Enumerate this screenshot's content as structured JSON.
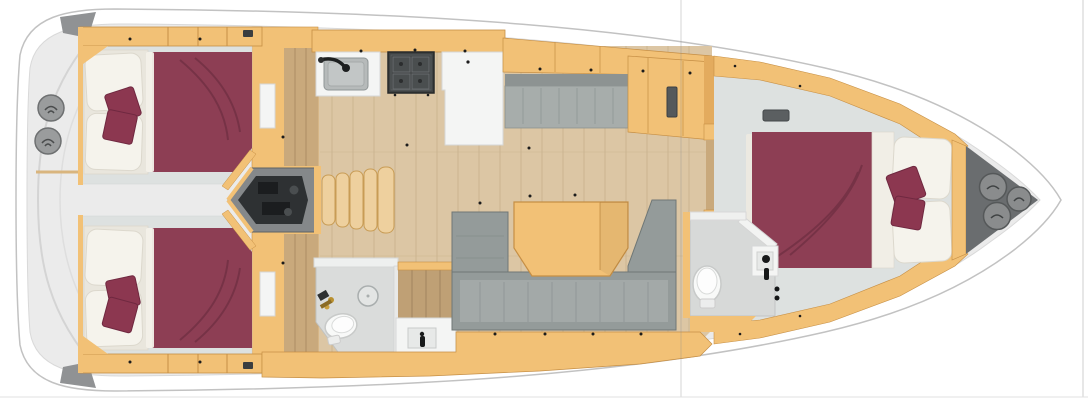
{
  "diagram": {
    "kind": "sailing-yacht-interior-floorplan",
    "orientation": "bow-right-stern-left"
  },
  "structure": {
    "aft_cabins": 2,
    "forward_cabins": 1,
    "heads": 2,
    "companionway_steps": 5,
    "stern_deck_hatches": 2,
    "bow_locker_hatches": 3,
    "salon_tables": 1
  },
  "palette": {
    "wood": "#f2c176",
    "wood_edge": "#c68f45",
    "wood_light": "#eed09e",
    "wood_step_edge": "#c89c55",
    "corridor_floor": "#c9a97c",
    "salon_floor": "#dcc6a4",
    "floor_seam": "#b89f78",
    "cabin_floor": "#dde1e0",
    "deck": "#ebebeb",
    "deck_seam": "#d4d4d4",
    "hull_line": "#c2c2c2",
    "bed": "#8d3e54",
    "bed_shade": "#6f2840",
    "pillow": "#8c3750",
    "mattress": "#f5f3ec",
    "mattress_shade": "#dcd8cd",
    "sofa": "#949b9a",
    "sofa_seat": "#a3a9a8",
    "sofa_edge": "#6f7776",
    "bench_back": "#8d9392",
    "bench_seat": "#a7adab",
    "engine_bay": "#85888a",
    "engine": "#2e3133",
    "engine_dark": "#1b1d1f",
    "stove": "#3f4243",
    "stove_grate": "#676b6c",
    "basin": "#b6baba",
    "fixture": "#f4f5f4",
    "fixture_edge": "#d6d8d7",
    "fixture_inner": "#e7e9e8",
    "locker": "#6a6d6f",
    "hatch": "#8a8c8d",
    "hatch_edge": "#555859",
    "stern_circle": "#9a9c9d",
    "stern_circle_edge": "#6e7071",
    "gold": "#b9902f",
    "dot": "#1c1c1c",
    "black": "#17191a",
    "artifact_line": "#8c8c8c"
  }
}
